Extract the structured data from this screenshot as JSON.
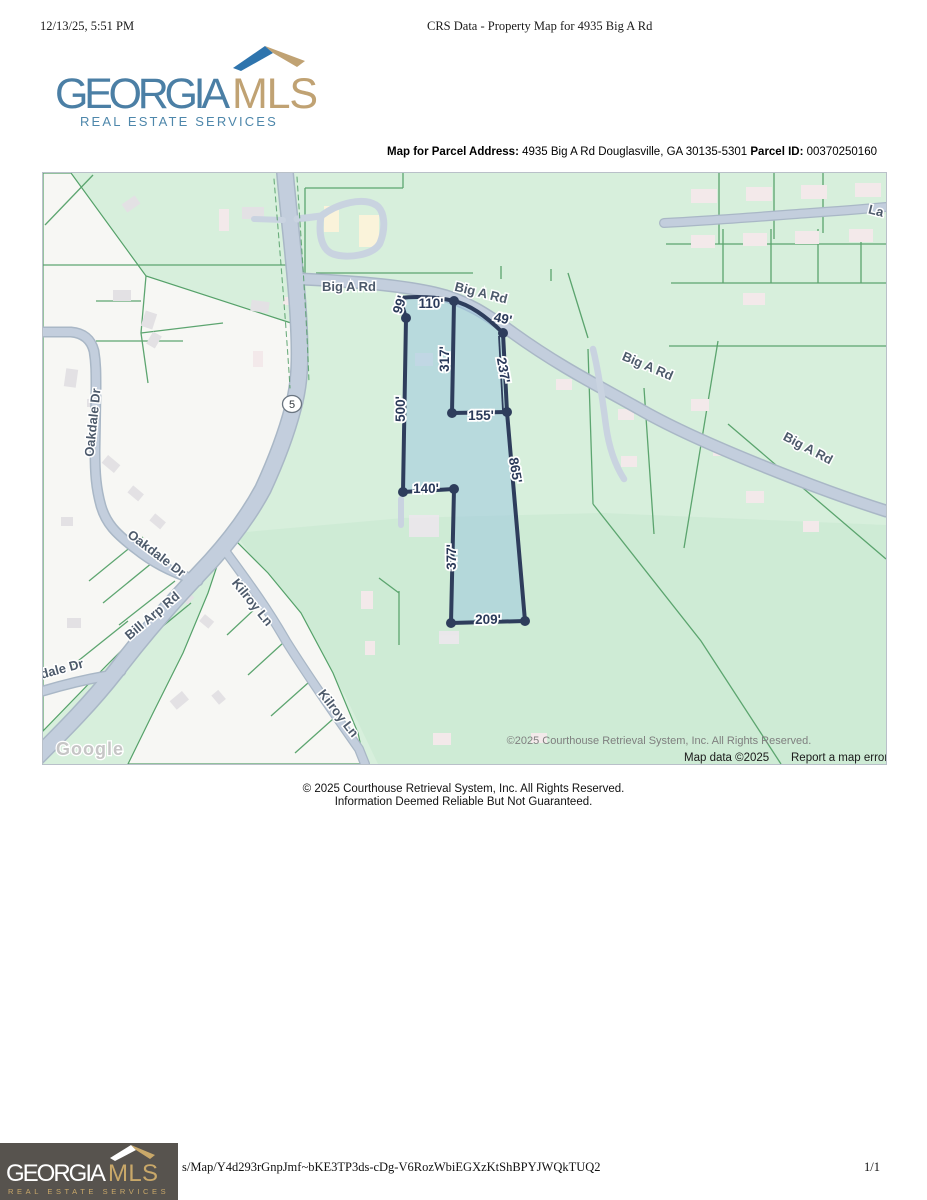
{
  "page": {
    "printed_datetime": "12/13/25, 5:51 PM",
    "print_title": "CRS Data - Property Map for 4935 Big A Rd",
    "footer_url": "s/Map/Y4d293rGnpJmf~bKE3TP3ds-cDg-V6RozWbiEGXzKtShBPYJWQkTUQ2",
    "page_number": "1/1"
  },
  "brand": {
    "name_part1": "GEORGIA",
    "name_part2": "MLS",
    "tagline": "REAL ESTATE SERVICES",
    "colors": {
      "blue": "#4b7fa5",
      "tan": "#c0a273",
      "roof_blue": "#2e74ad",
      "footer_bg": "#57534e"
    }
  },
  "parcel_header": {
    "label_address": "Map for Parcel Address:",
    "address": "4935 Big A Rd Douglasville, GA 30135-5301",
    "label_parcel_id": "Parcel ID:",
    "parcel_id": "00370250160"
  },
  "map": {
    "highway_shield": "5",
    "watermark": "Google",
    "attribution_overlay": "©2025 Courthouse Retrieval System, Inc. All Rights Reserved.",
    "map_data_text": "Map data ©2025",
    "report_error_text": "Report a map error",
    "road_labels": [
      {
        "text": "Big A Rd"
      },
      {
        "text": "Big A Rd"
      },
      {
        "text": "Big A Rd"
      },
      {
        "text": "Big A Rd"
      },
      {
        "text": "La"
      },
      {
        "text": "Oakdale Dr"
      },
      {
        "text": "Oakdale Dr"
      },
      {
        "text": "Bill Arp Rd"
      },
      {
        "text": "Kilroy Ln"
      },
      {
        "text": "Kilroy Ln"
      },
      {
        "text": "dale Dr"
      }
    ],
    "subject_parcel": {
      "dimension_labels": [
        {
          "text": "99'"
        },
        {
          "text": "110'"
        },
        {
          "text": "49'"
        },
        {
          "text": "317'"
        },
        {
          "text": "237'"
        },
        {
          "text": "155'"
        },
        {
          "text": "500'"
        },
        {
          "text": "865'"
        },
        {
          "text": "140'"
        },
        {
          "text": "377'"
        },
        {
          "text": "209'"
        }
      ]
    }
  },
  "below_map": {
    "line1": "© 2025 Courthouse Retrieval System, Inc. All Rights Reserved.",
    "line2": "Information Deemed Reliable But Not Guaranteed."
  }
}
